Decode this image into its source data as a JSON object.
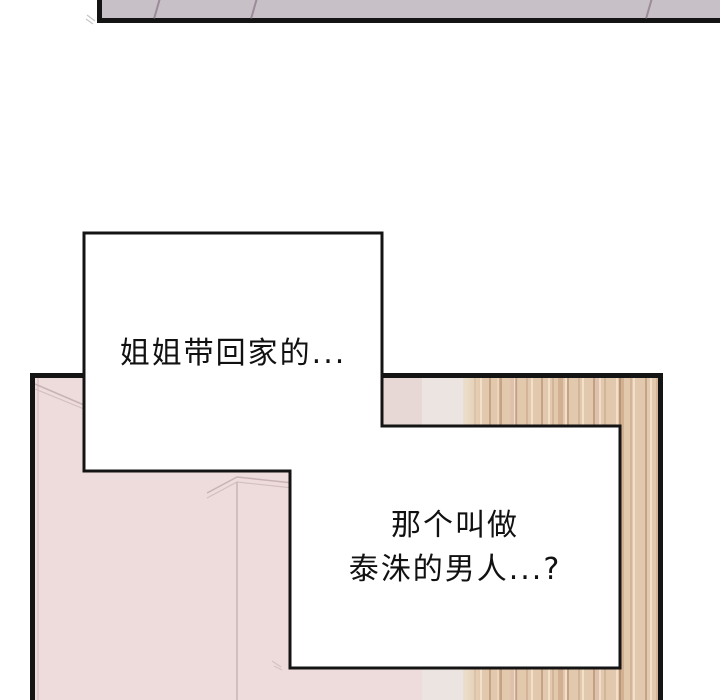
{
  "colors": {
    "page-bg": "#ffffff",
    "ink": "#141414",
    "ceiling-fill": "#c7c1c7",
    "ceiling-seam": "#8d7888",
    "wall-pink": "#eedbdb",
    "wall-shade": "#e7d8d6",
    "wall-line": "#c9b3b7",
    "door-frame-light": "#ece4e1",
    "wood-base": "#e2c8ac",
    "bubble-fill": "#ffffff",
    "text-color": "#111111"
  },
  "bubbles": {
    "bubble1": {
      "text": "姐姐带回家的..."
    },
    "bubble2": {
      "line1": "那个叫做",
      "line2": "泰洙的男人...?"
    }
  }
}
